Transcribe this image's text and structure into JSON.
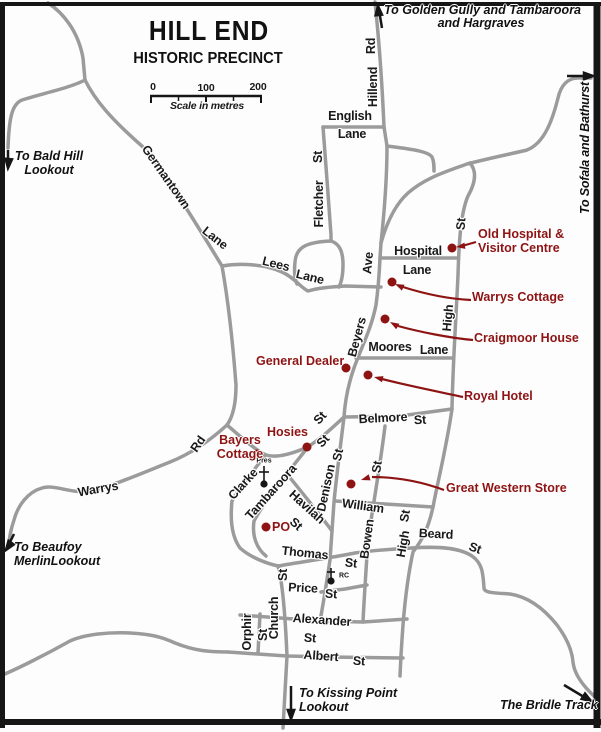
{
  "title": {
    "main": "HILL END",
    "sub": "HISTORIC PRECINCT"
  },
  "scale": {
    "t0": "0",
    "t100": "100",
    "t200": "200",
    "caption": "Scale in metres"
  },
  "directions": {
    "golden_gully": {
      "line1": "To Golden Gully and Tambaroora",
      "line2": "and Hargraves"
    },
    "sofala": "To Sofala and Bathurst",
    "bald_hill": {
      "line1": "To Bald Hill",
      "line2": "Lookout"
    },
    "beaufoy": {
      "line1": "To Beaufoy",
      "line2": "MerlinLookout"
    },
    "kissing_point": {
      "line1": "To Kissing Point",
      "line2": "Lookout"
    },
    "bridle_track": "The Bridle Track"
  },
  "streets": {
    "hillend": {
      "p1": "Hillend",
      "p2": "Rd"
    },
    "english": {
      "p1": "English",
      "p2": "Lane"
    },
    "fletcher": {
      "p1": "Fletcher",
      "p2": "St"
    },
    "germantown": {
      "p1": "Germantown",
      "p2": "Lane"
    },
    "lees": {
      "p1": "Lees",
      "p2": "Lane"
    },
    "beyers": {
      "p1": "Beyers",
      "p2": "Ave"
    },
    "hospital_lane": {
      "p1": "Hospital",
      "p2": "Lane"
    },
    "high_north": {
      "p1": "High",
      "p2": "St"
    },
    "moores": {
      "p1": "Moores",
      "p2": "Lane"
    },
    "belmore": {
      "p1": "Belmore",
      "p2": "St"
    },
    "warrys": {
      "p1": "Warrys",
      "p2": "Rd"
    },
    "clarke": {
      "p1": "Clarke",
      "p2": "St"
    },
    "tambaroora": {
      "p1": "Tambaroora",
      "p2": "St"
    },
    "havilah": {
      "p1": "Havilah",
      "p2": "St"
    },
    "denison": {
      "p1": "Denison",
      "p2": "St"
    },
    "william": {
      "p1": "William"
    },
    "bowen": {
      "p1": "Bowen",
      "p2": "St"
    },
    "high_south": {
      "p1": "High",
      "p2": "St"
    },
    "thomas": {
      "p1": "Thomas",
      "p2": "St"
    },
    "price": {
      "p1": "Price",
      "p2": "St"
    },
    "church": {
      "p1": "Church",
      "p2": "St"
    },
    "orphir": {
      "p1": "Orphir",
      "p2": "St"
    },
    "alexander": {
      "p1": "Alexander",
      "p2": "St"
    },
    "albert": {
      "p1": "Albert",
      "p2": "St"
    },
    "beard": {
      "p1": "Beard",
      "p2": "St"
    }
  },
  "pois": {
    "old_hospital": {
      "line1": "Old Hospital &",
      "line2": "Visitor Centre"
    },
    "warrys_cottage": "Warrys Cottage",
    "craigmoor_house": "Craigmoor House",
    "general_dealer": "General Dealer",
    "royal_hotel": "Royal Hotel",
    "hosies": "Hosies",
    "bayers_cottage": {
      "line1": "Bayers",
      "line2": "Cottage"
    },
    "great_western_store": "Great Western Store",
    "po": "PO"
  },
  "churches": {
    "pres": "Pres",
    "rc": "RC"
  },
  "colors": {
    "poi_red": "#8e1414",
    "road_gray": "#9b9b9b",
    "ink": "#161616",
    "background": "#fdfdfd"
  }
}
